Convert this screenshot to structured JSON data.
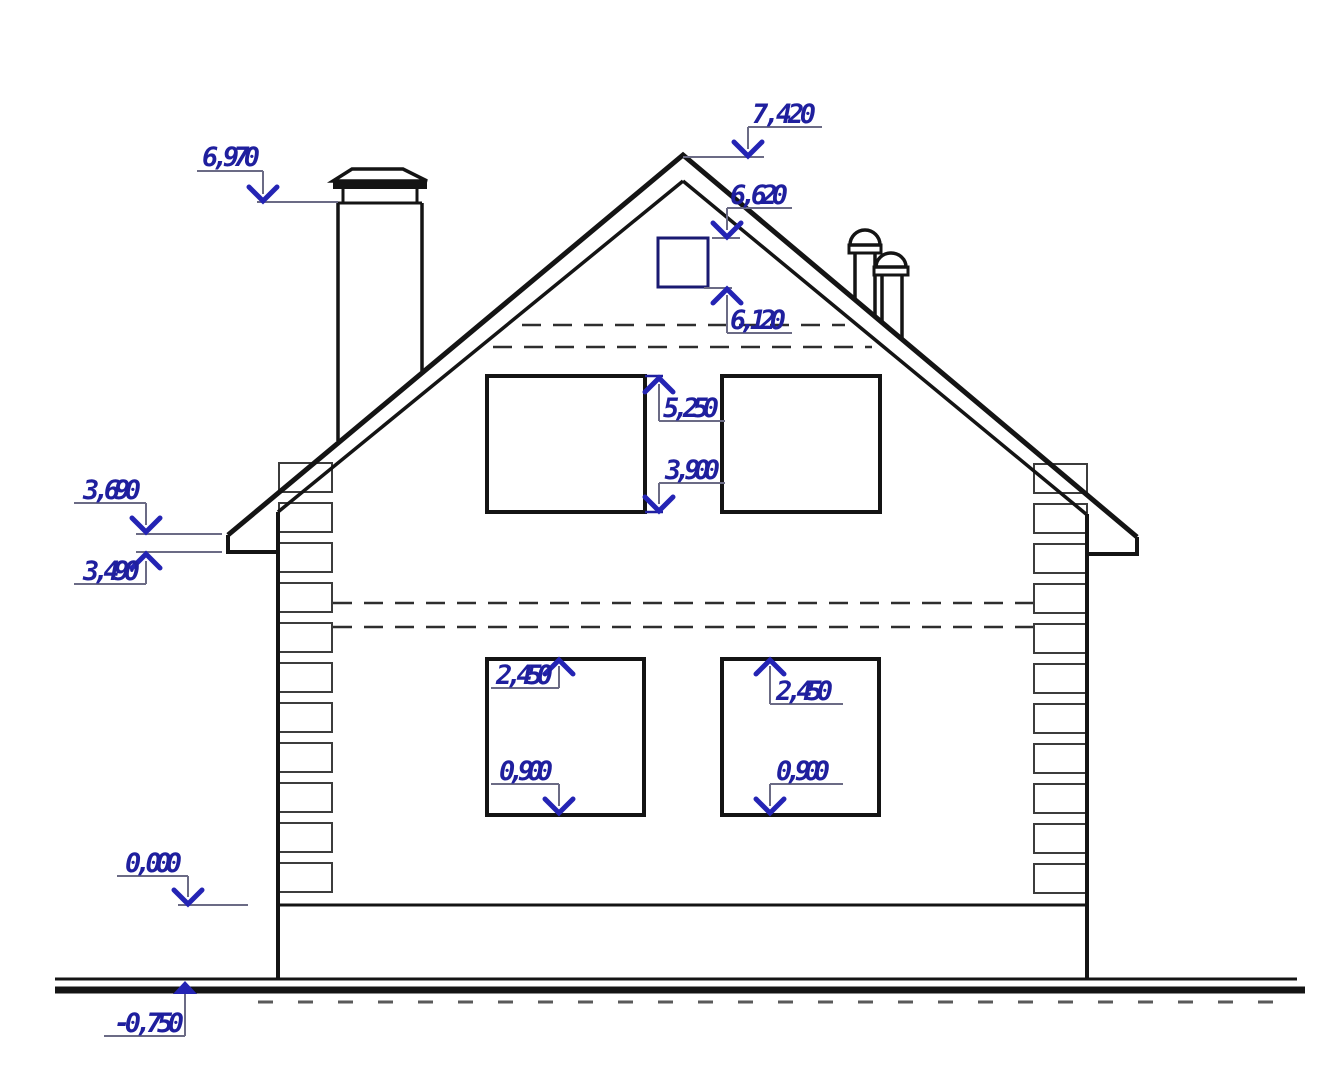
{
  "meta": {
    "drawing_type": "house-gable-elevation",
    "units": "meters",
    "scale_px_per_m": 101
  },
  "colors": {
    "line": "#141414",
    "quoin_line": "#3c3c3c",
    "dashed_line": "#2e2e2e",
    "hatch_line": "#5a5a5a",
    "dim_text": "#1f1f9e",
    "dim_arrow": "#2424b4",
    "dim_leader": "#6b6b85",
    "window_navy": "#1a1a72",
    "background": "#ffffff"
  },
  "levels_shown": [
    "7,420",
    "6,970",
    "6,620",
    "6,120",
    "5,250",
    "3,900",
    "3,690",
    "3,490",
    "2,450",
    "0,900",
    "0,000",
    "-0,750"
  ],
  "dimensions": [
    {
      "id": "dim-7420",
      "label": "7,420",
      "text": {
        "x": 752,
        "y": 123,
        "len": 64
      },
      "underline": {
        "x1": 748,
        "x2": 822,
        "y": 127
      },
      "leader": {
        "x": 748,
        "y1": 127,
        "y2": 149
      },
      "arrow": {
        "x": 748,
        "y": 156,
        "dir": "down",
        "style": "chevron"
      },
      "level_line": {
        "x1": 683,
        "x2": 764,
        "y": 157,
        "color": "gray"
      }
    },
    {
      "id": "dim-6970",
      "label": "6,970",
      "text": {
        "x": 202,
        "y": 166,
        "len": 58
      },
      "underline": {
        "x1": 197,
        "x2": 263,
        "y": 171
      },
      "leader": {
        "x": 263,
        "y1": 171,
        "y2": 194
      },
      "arrow": {
        "x": 263,
        "y": 201,
        "dir": "down",
        "style": "chevron"
      },
      "level_line": {
        "x1": 257,
        "x2": 338,
        "y": 202,
        "color": "gray"
      }
    },
    {
      "id": "dim-6620",
      "label": "6,620",
      "text": {
        "x": 730,
        "y": 204,
        "len": 58
      },
      "underline": {
        "x1": 727,
        "x2": 792,
        "y": 208
      },
      "leader": {
        "x": 727,
        "y1": 208,
        "y2": 230
      },
      "arrow": {
        "x": 727,
        "y": 237,
        "dir": "down",
        "style": "chevron"
      },
      "level_line": {
        "x1": 712,
        "x2": 740,
        "y": 238,
        "color": "gray"
      }
    },
    {
      "id": "dim-6120",
      "label": "6,120",
      "text": {
        "x": 730,
        "y": 329,
        "len": 56
      },
      "underline": {
        "x1": 727,
        "x2": 792,
        "y": 333
      },
      "leader": {
        "x": 727,
        "y1": 295,
        "y2": 333
      },
      "arrow": {
        "x": 727,
        "y": 289,
        "dir": "up",
        "style": "chevron"
      },
      "level_line": {
        "x1": 704,
        "x2": 732,
        "y": 288,
        "color": "gray"
      }
    },
    {
      "id": "dim-5250",
      "label": "5,250",
      "text": {
        "x": 663,
        "y": 417,
        "len": 56
      },
      "underline": {
        "x1": 659,
        "x2": 725,
        "y": 421
      },
      "leader": {
        "x": 659,
        "y1": 384,
        "y2": 421
      },
      "arrow": {
        "x": 659,
        "y": 378,
        "dir": "up",
        "style": "chevron"
      },
      "level_line": {
        "x1": 645,
        "x2": 663,
        "y": 376,
        "color": "navy"
      }
    },
    {
      "id": "dim-3900",
      "label": "3,900",
      "text": {
        "x": 665,
        "y": 479,
        "len": 55
      },
      "underline": {
        "x1": 659,
        "x2": 725,
        "y": 483
      },
      "leader": {
        "x": 659,
        "y1": 483,
        "y2": 504
      },
      "arrow": {
        "x": 659,
        "y": 511,
        "dir": "down",
        "style": "chevron"
      },
      "level_line": {
        "x1": 645,
        "x2": 663,
        "y": 512,
        "color": "navy"
      }
    },
    {
      "id": "dim-3690",
      "label": "3,690",
      "text": {
        "x": 83,
        "y": 499,
        "len": 58
      },
      "underline": {
        "x1": 74,
        "x2": 146,
        "y": 503
      },
      "leader": {
        "x": 146,
        "y1": 503,
        "y2": 525
      },
      "arrow": {
        "x": 146,
        "y": 532,
        "dir": "down",
        "style": "chevron"
      },
      "level_line": {
        "x1": 136,
        "x2": 222,
        "y": 534,
        "color": "gray"
      }
    },
    {
      "id": "dim-3490",
      "label": "3,490",
      "text": {
        "x": 83,
        "y": 580,
        "len": 57
      },
      "underline": {
        "x1": 74,
        "x2": 146,
        "y": 584
      },
      "leader": {
        "x": 146,
        "y1": 561,
        "y2": 584
      },
      "arrow": {
        "x": 146,
        "y": 554,
        "dir": "up",
        "style": "chevron"
      },
      "level_line": {
        "x1": 136,
        "x2": 222,
        "y": 552,
        "color": "gray"
      }
    },
    {
      "id": "dim-2450-left",
      "label": "2,450",
      "text": {
        "x": 496,
        "y": 684,
        "len": 57
      },
      "underline": {
        "x1": 491,
        "x2": 559,
        "y": 688
      },
      "leader": {
        "x": 559,
        "y1": 666,
        "y2": 688
      },
      "arrow": {
        "x": 559,
        "y": 660,
        "dir": "up",
        "style": "chevron"
      },
      "level_line": null
    },
    {
      "id": "dim-0900-left",
      "label": "0,900",
      "text": {
        "x": 499,
        "y": 780,
        "len": 54
      },
      "underline": {
        "x1": 491,
        "x2": 559,
        "y": 784
      },
      "leader": {
        "x": 559,
        "y1": 784,
        "y2": 806
      },
      "arrow": {
        "x": 559,
        "y": 813,
        "dir": "down",
        "style": "chevron"
      },
      "level_line": null
    },
    {
      "id": "dim-2450-right",
      "label": "2,450",
      "text": {
        "x": 776,
        "y": 700,
        "len": 57
      },
      "underline": {
        "x1": 770,
        "x2": 843,
        "y": 704
      },
      "leader": {
        "x": 770,
        "y1": 666,
        "y2": 704
      },
      "arrow": {
        "x": 770,
        "y": 660,
        "dir": "up",
        "style": "chevron"
      },
      "level_line": null
    },
    {
      "id": "dim-0900-right",
      "label": "0,900",
      "text": {
        "x": 776,
        "y": 780,
        "len": 54
      },
      "underline": {
        "x1": 770,
        "x2": 843,
        "y": 784
      },
      "leader": {
        "x": 770,
        "y1": 784,
        "y2": 806
      },
      "arrow": {
        "x": 770,
        "y": 813,
        "dir": "down",
        "style": "chevron"
      },
      "level_line": null
    },
    {
      "id": "dim-0000",
      "label": "0,000",
      "text": {
        "x": 125,
        "y": 872,
        "len": 57
      },
      "underline": {
        "x1": 117,
        "x2": 188,
        "y": 876
      },
      "leader": {
        "x": 188,
        "y1": 876,
        "y2": 897
      },
      "arrow": {
        "x": 188,
        "y": 904,
        "dir": "down",
        "style": "chevron"
      },
      "level_line": {
        "x1": 178,
        "x2": 248,
        "y": 905,
        "color": "gray"
      }
    },
    {
      "id": "dim-neg-0750",
      "label": "-0,750",
      "text": {
        "x": 114,
        "y": 1032,
        "len": 70
      },
      "underline": {
        "x1": 104,
        "x2": 185,
        "y": 1036
      },
      "leader": {
        "x": 185,
        "y1": 990,
        "y2": 1036
      },
      "arrow": {
        "x": 185,
        "y": 981,
        "dir": "up",
        "style": "triangle"
      },
      "level_line": null
    }
  ],
  "structure": {
    "roof": {
      "outer": [
        [
          228,
          535
        ],
        [
          683,
          155
        ],
        [
          1137,
          537
        ]
      ],
      "inner_left": [
        278,
        512,
        683,
        181
      ],
      "inner_right": [
        683,
        181,
        1086,
        514
      ],
      "left_fascia": [
        [
          228,
          535
        ],
        [
          228,
          552
        ],
        [
          278,
          552
        ]
      ],
      "right_fascia": [
        [
          1137,
          537
        ],
        [
          1137,
          554
        ],
        [
          1087,
          554
        ]
      ]
    },
    "walls": {
      "left": [
        278,
        512,
        278,
        979
      ],
      "right": [
        1087,
        514,
        1087,
        979
      ],
      "plinth_top": [
        278,
        905,
        1087,
        905
      ]
    },
    "ground": {
      "thin": [
        55,
        979,
        1297,
        979
      ],
      "thick": [
        55,
        990,
        1305,
        990
      ],
      "hatch": {
        "y": 1002,
        "x1": 258,
        "x2": 1292,
        "dash": "15 25"
      }
    },
    "windows": [
      {
        "name": "attic-window",
        "x": 658,
        "y": 238,
        "w": 50,
        "h": 49,
        "color": "navy",
        "sw": 3
      },
      {
        "name": "upper-left-window",
        "x": 487,
        "y": 376,
        "w": 158,
        "h": 136,
        "color": "line",
        "sw": 4
      },
      {
        "name": "upper-right-window",
        "x": 722,
        "y": 376,
        "w": 158,
        "h": 136,
        "color": "line",
        "sw": 4
      },
      {
        "name": "lower-left-window",
        "x": 487,
        "y": 659,
        "w": 157,
        "h": 156,
        "color": "line",
        "sw": 4
      },
      {
        "name": "lower-right-window",
        "x": 722,
        "y": 659,
        "w": 157,
        "h": 156,
        "color": "line",
        "sw": 4
      }
    ],
    "dashed_lines": [
      {
        "name": "attic-floor-dashed-upper",
        "p": [
          522,
          325,
          845,
          325
        ]
      },
      {
        "name": "attic-floor-dashed-lower",
        "p": [
          493,
          347,
          872,
          347
        ]
      },
      {
        "name": "second-floor-dashed-upper",
        "p": [
          333,
          603,
          1033,
          603
        ]
      },
      {
        "name": "second-floor-dashed-lower",
        "p": [
          333,
          627,
          1033,
          627
        ]
      }
    ],
    "quoins": {
      "left_x": 279,
      "right_x": 1034,
      "w": 53,
      "h": 29,
      "y0": 463,
      "pitch": 40,
      "count": 11
    },
    "chimney": {
      "cap_poly": [
        [
          352,
          169
        ],
        [
          403,
          169
        ],
        [
          427,
          181
        ],
        [
          333,
          181
        ]
      ],
      "band": [
        333,
        181,
        94,
        8
      ],
      "neck_left": [
        343,
        189,
        343,
        203
      ],
      "neck_right": [
        417,
        189,
        417,
        203
      ],
      "body_top": [
        338,
        203,
        422,
        203
      ],
      "body_left": [
        338,
        203,
        338,
        441
      ],
      "body_right": [
        422,
        203,
        422,
        371
      ]
    },
    "vents": [
      {
        "name": "vent-pipe-1",
        "dome": {
          "cx": 865,
          "cy": 245,
          "rx": 15,
          "ry": 15
        },
        "collar": [
          849,
          245,
          32,
          8
        ],
        "body_left": [
          855,
          253,
          855,
          300
        ],
        "body_right": [
          875,
          253,
          875,
          317
        ]
      },
      {
        "name": "vent-pipe-2",
        "dome": {
          "cx": 891,
          "cy": 267,
          "rx": 15,
          "ry": 14
        },
        "collar": [
          874,
          267,
          34,
          8
        ],
        "body_left": [
          882,
          275,
          882,
          322
        ],
        "body_right": [
          902,
          275,
          902,
          339
        ]
      }
    ]
  }
}
